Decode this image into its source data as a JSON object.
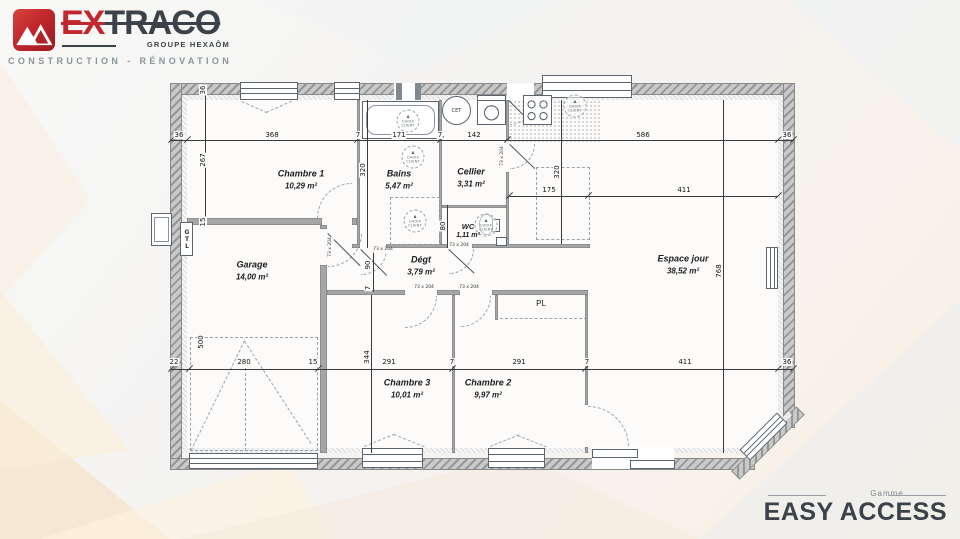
{
  "header": {
    "brand_prefix": "EX",
    "brand_suffix": "TRACO",
    "group": "GROUPE HEXAÔM",
    "tagline": "CONSTRUCTION - RÉNOVATION"
  },
  "footer": {
    "range_label": "Gamme",
    "range_name": "EASY ACCESS"
  },
  "plan": {
    "rooms": [
      {
        "name": "Chambre 1",
        "area": "10,29 m²"
      },
      {
        "name": "Bains",
        "area": "5,47 m²"
      },
      {
        "name": "Cellier",
        "area": "3,31 m²"
      },
      {
        "name": "WC",
        "area": "1,11 m²"
      },
      {
        "name": "Garage",
        "area": "14,00 m²"
      },
      {
        "name": "Dégt",
        "area": "3,79 m²"
      },
      {
        "name": "Espace jour",
        "area": "38,52 m²"
      },
      {
        "name": "Chambre 3",
        "area": "10,01 m²"
      },
      {
        "name": "Chambre 2",
        "area": "9,97 m²"
      },
      {
        "name": "PL",
        "area": ""
      }
    ],
    "annotations": {
      "gtl": "GTL",
      "cet": "CET",
      "door_size": "73 x 204",
      "client_choice_line1": "CHOIX",
      "client_choice_line2": "CLIENT"
    },
    "dims": {
      "top": [
        "36",
        "368",
        "7",
        "171",
        "7",
        "142",
        "586",
        "36"
      ],
      "mid": [
        "175",
        "411"
      ],
      "bottom": [
        "22",
        "280",
        "15",
        "291",
        "7",
        "291",
        "7",
        "411",
        "36"
      ],
      "left": [
        "36",
        "267",
        "15"
      ],
      "v": [
        "320",
        "320",
        "80",
        "90",
        "7",
        "500",
        "344",
        "768"
      ]
    }
  },
  "colors": {
    "accent_red": "#c1272d",
    "dark": "#3b4249"
  }
}
